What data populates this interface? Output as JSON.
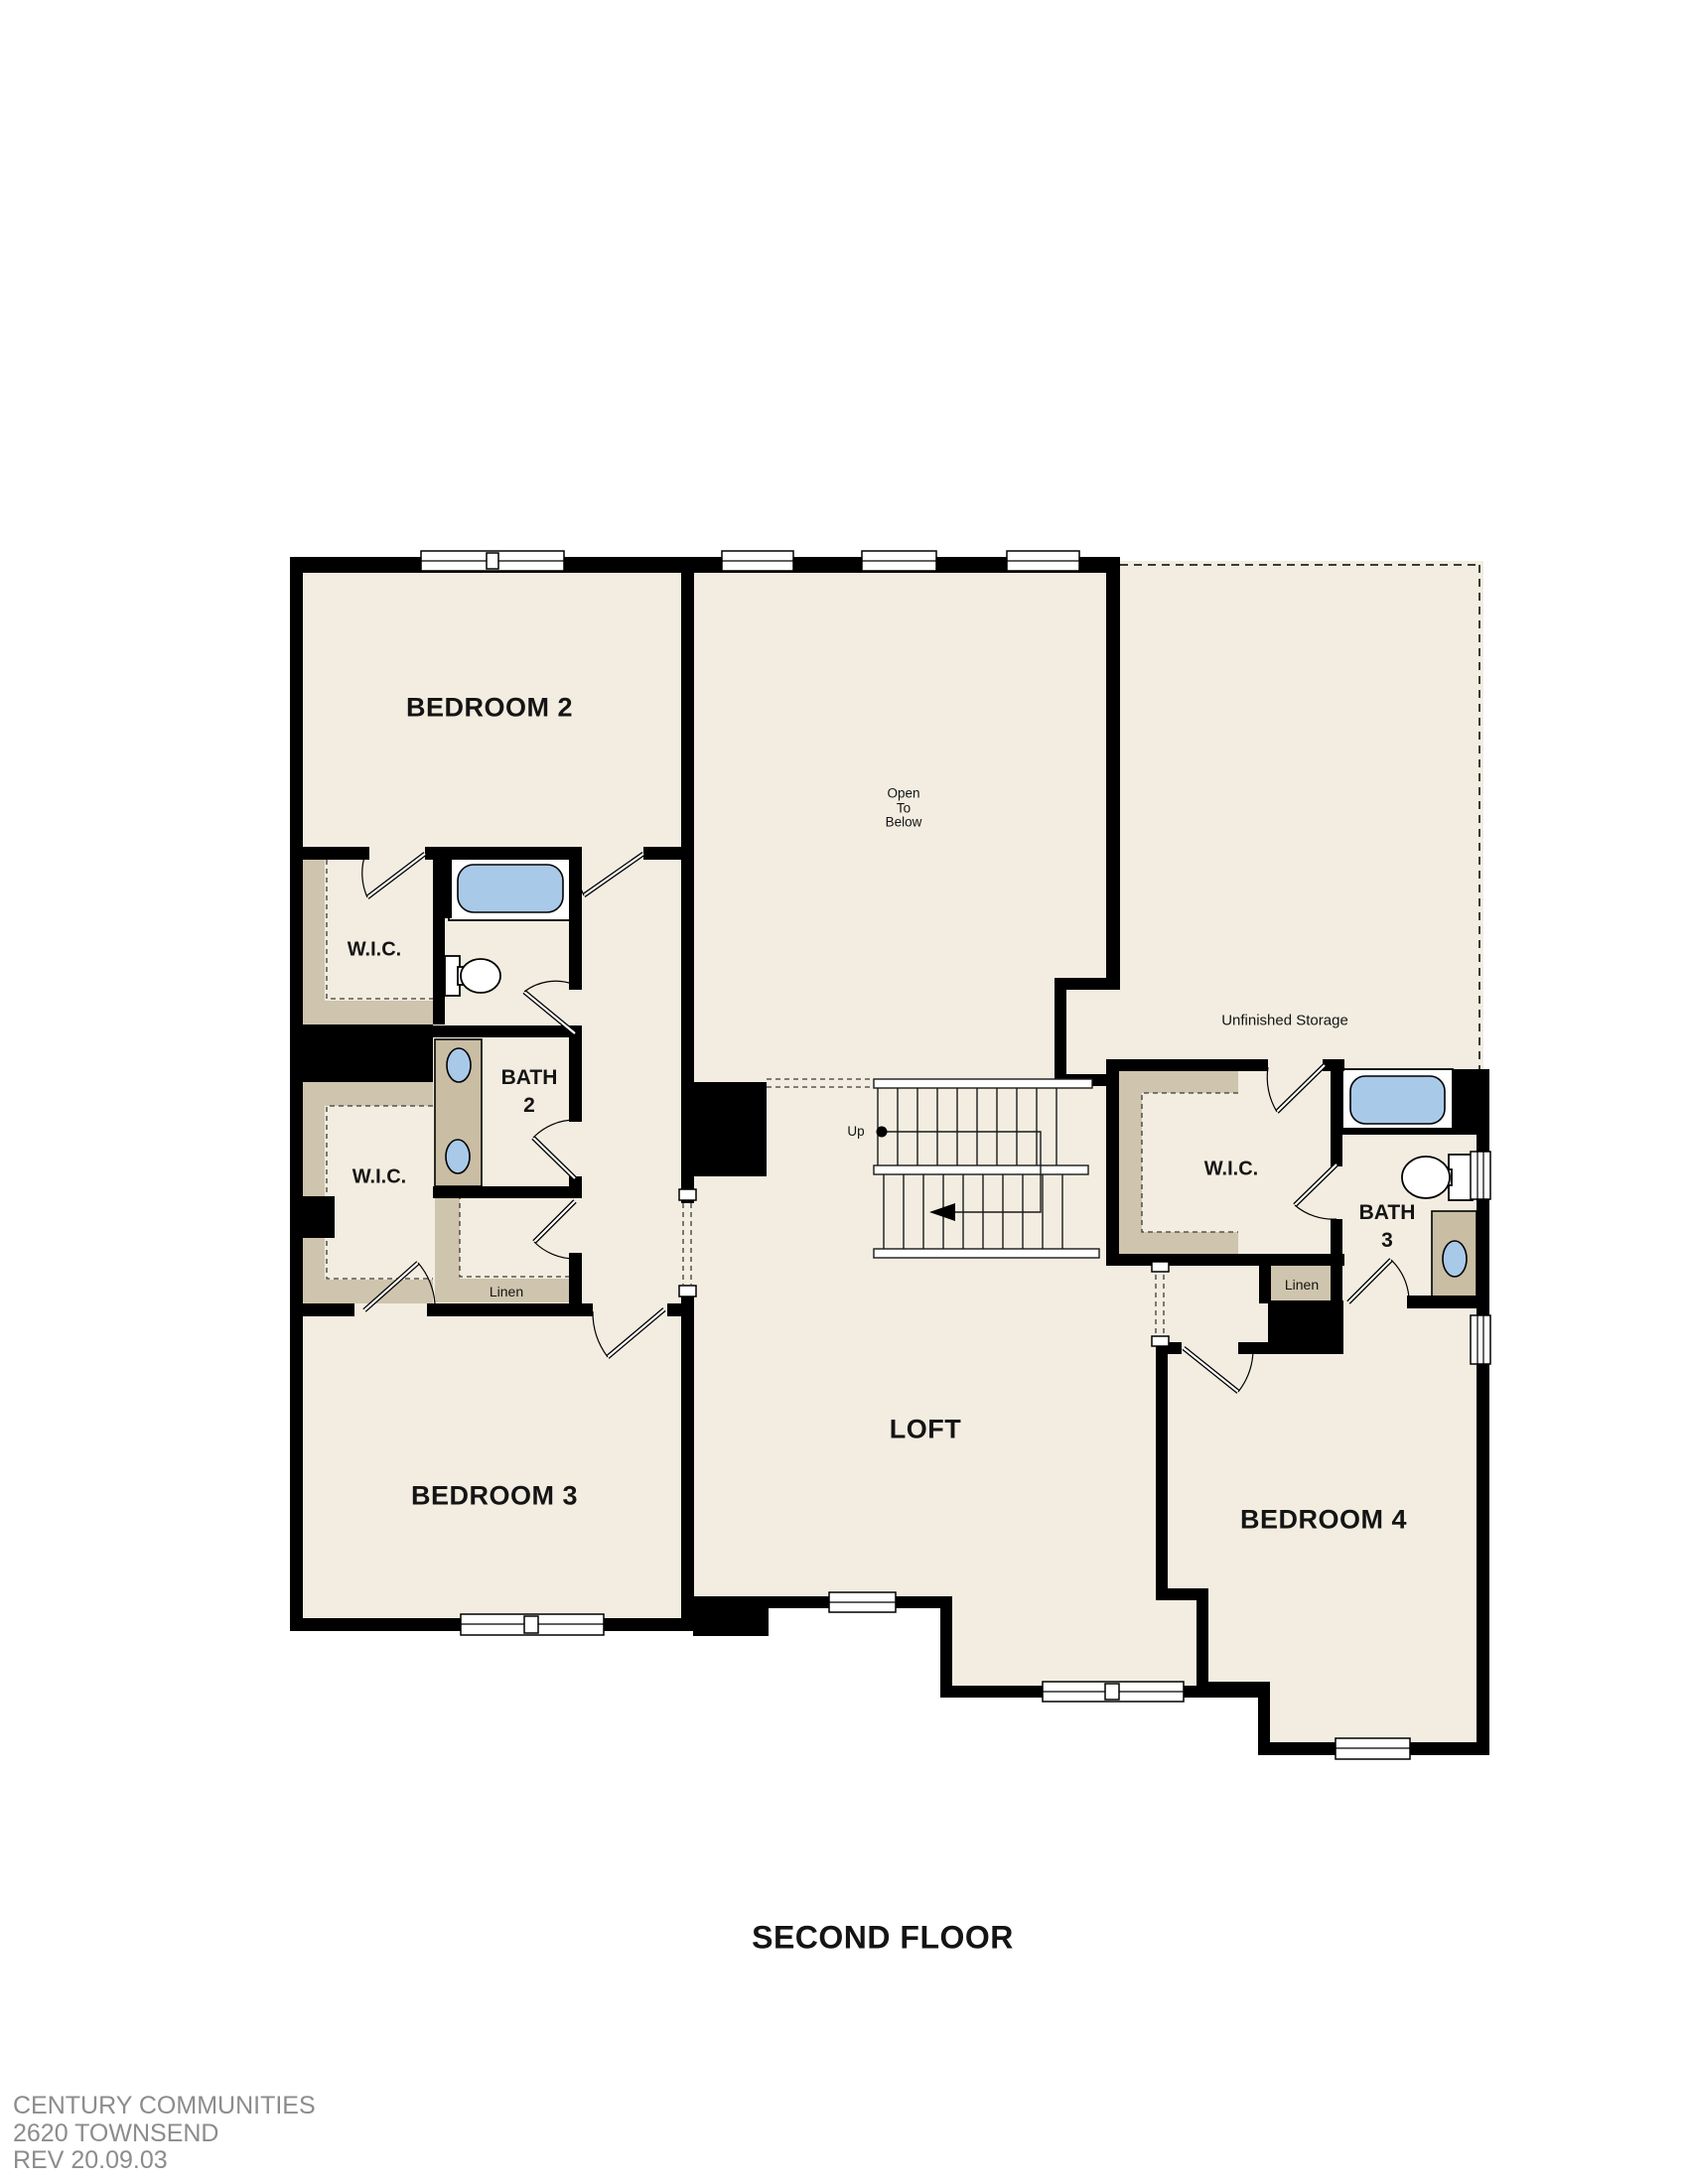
{
  "plan": {
    "title": "SECOND FLOOR",
    "labels": {
      "bedroom2": "BEDROOM 2",
      "bedroom3": "BEDROOM 3",
      "bedroom4": "BEDROOM 4",
      "loft": "LOFT",
      "wic": "W.I.C.",
      "bath2": "BATH\n2",
      "bath3": "BATH\n3",
      "linen": "Linen",
      "unfinished_storage": "Unfinished Storage",
      "open_to_below": "Open\nTo\nBelow",
      "up": "Up"
    }
  },
  "footer": {
    "company": "CENTURY COMMUNITIES",
    "model": "2620 TOWNSEND",
    "revision": "REV 20.09.03"
  },
  "colors": {
    "floor": "#f2ede0",
    "wall": "#000000",
    "shelf": "#cfc4ad",
    "vanity": "#c9bda4",
    "fixture": "#a9c9e9",
    "footer_text": "#8c8c8c",
    "label_text": "#141414"
  }
}
